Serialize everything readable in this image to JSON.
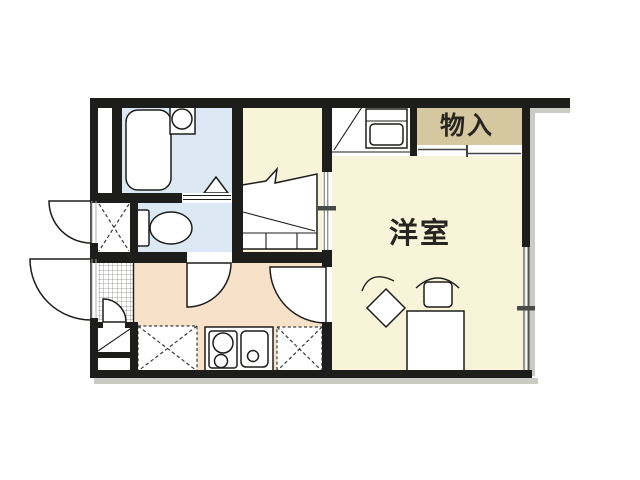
{
  "floorplan": {
    "labels": {
      "storage": "物入",
      "western_room": "洋室"
    },
    "colors": {
      "wall": "#1d1d1b",
      "wet_floor": "#dce9f4",
      "room_floor": "#f8f4da",
      "kitchen_floor": "#f8e1c9",
      "storage_floor": "#d5c8a0",
      "window_line": "#98978c",
      "window_dark_line": "#55544c",
      "tick": "#4a4a4a",
      "shadow": "#cbcbc6",
      "outline": "#1d1d1b"
    },
    "fixtures": {
      "bathtub": "bathtub-icon",
      "wash_basin": "wash-basin-icon",
      "bath_door": "folding-door-triangle-icon",
      "toilet": "toilet-icon",
      "entry_closet": "dashed-x-space-icon",
      "genkan_tile": "entrance-tile-hatch",
      "entry_steps": "entrance-steps-icon",
      "loft_stairs": "loft-stairs-icon",
      "washing_machine": "washing-machine-icon",
      "stove": "two-burner-stove-icon",
      "sink": "kitchen-sink-icon",
      "appliance_space_left": "dashed-x-space-icon",
      "appliance_space_right": "dashed-x-space-icon",
      "desk": "desk-icon",
      "chair_front": "chair-icon",
      "chair_side": "chair-rotated-icon",
      "doors": "door-swing-arc-icon",
      "storage_sliding_door": "sliding-door-lines-icon",
      "window": "double-line-window-icon"
    }
  }
}
